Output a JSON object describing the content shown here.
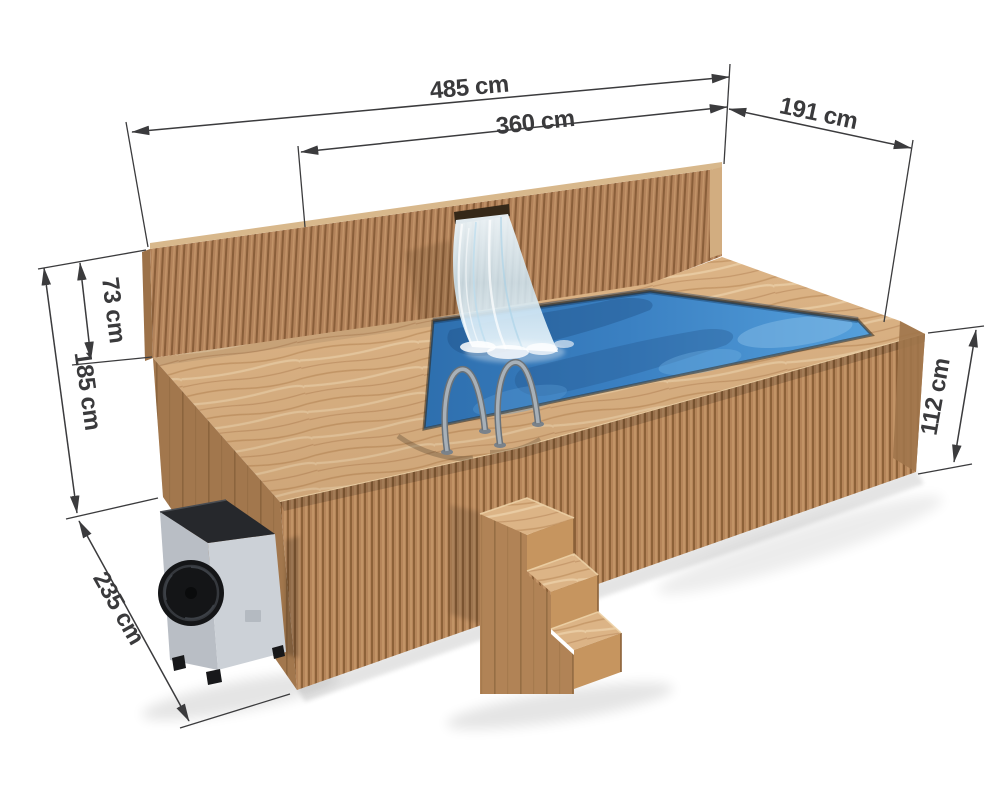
{
  "diagram": {
    "type": "product-dimension-diagram",
    "subject": "wooden outdoor pool with waterfall wall, heat pump, steps and ladder",
    "units": "cm",
    "dimensions": {
      "overall_length": {
        "label": "485 cm",
        "value": 485,
        "unit": "cm"
      },
      "inner_length": {
        "label": "360 cm",
        "value": 360,
        "unit": "cm"
      },
      "end_width": {
        "label": "191 cm",
        "value": 191,
        "unit": "cm"
      },
      "wall_above_deck": {
        "label": "73 cm",
        "value": 73,
        "unit": "cm"
      },
      "total_height": {
        "label": "185 cm",
        "value": 185,
        "unit": "cm"
      },
      "body_height": {
        "label": "112 cm",
        "value": 112,
        "unit": "cm"
      },
      "depth": {
        "label": "235 cm",
        "value": 235,
        "unit": "cm"
      }
    },
    "colors": {
      "background": "#ffffff",
      "slat_wood": "#b5855a",
      "deck_wood": "#dcb486",
      "water_blue": "#3a80c2",
      "dimension_lines": "#3b3b3d",
      "heat_pump_body": "#c9ced4",
      "heat_pump_top": "#26282c"
    }
  }
}
